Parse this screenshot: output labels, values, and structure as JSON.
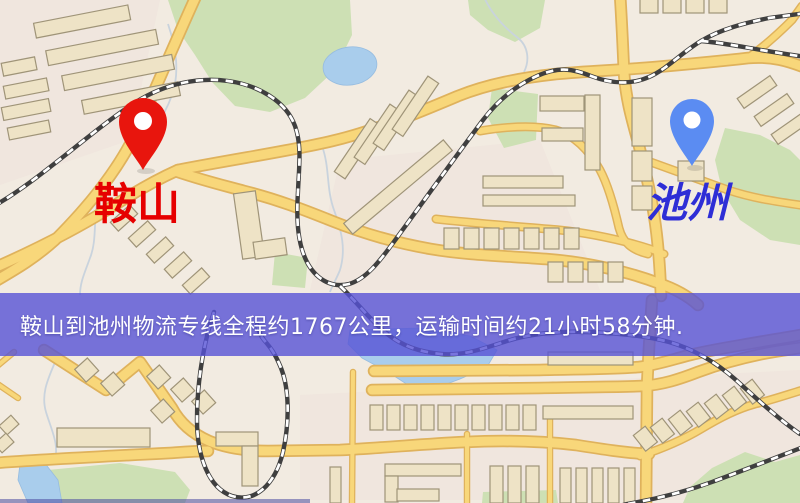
{
  "banner": {
    "text": "鞍山到池州物流专线全程约1767公里，运输时间约21小时58分钟.",
    "bg_color": "#5652d6",
    "text_color": "#ffffff"
  },
  "markers": {
    "origin": {
      "label": "鞍山",
      "pin_color": "#e8150d",
      "label_color": "#e60000"
    },
    "destination": {
      "label": "池州",
      "pin_color": "#5b8cf2",
      "label_color": "#2e2ed6"
    }
  },
  "map": {
    "colors": {
      "base": "#f2ebe1",
      "road_fill": "#f8d77a",
      "road_casing": "#dfb25c",
      "building": "#eee3c6",
      "building_outline": "#9f9478",
      "park": "#cde0b4",
      "water": "#a9cdec",
      "railway": "#3f3f3f"
    }
  }
}
